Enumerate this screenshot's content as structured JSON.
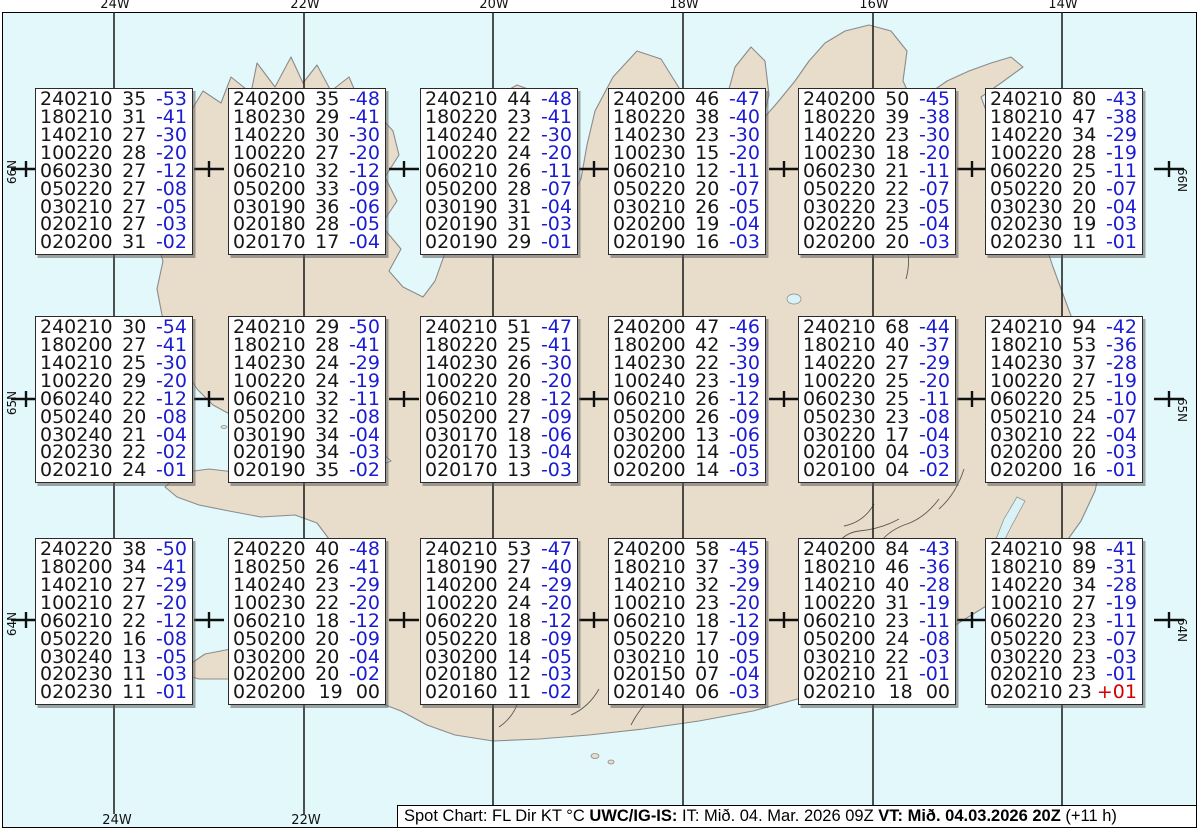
{
  "colors": {
    "ocean": "#e3f8fb",
    "land": "#e8dccb",
    "coast": "#8b8b8b",
    "rivers": "#5a5a52",
    "lake": "#d9f2f6",
    "grid": "#181818",
    "marker": "#101010",
    "temp_blue": "#1b1bd1",
    "temp_red": "#d40000",
    "text_black": "#161616"
  },
  "geo": {
    "top_labels": [
      {
        "label": "24W",
        "x": 115
      },
      {
        "label": "22W",
        "x": 305
      },
      {
        "label": "20W",
        "x": 494
      },
      {
        "label": "18W",
        "x": 684
      },
      {
        "label": "16W",
        "x": 874
      },
      {
        "label": "14W",
        "x": 1063
      }
    ],
    "bottom_labels": [
      {
        "label": "24W",
        "x": 117
      },
      {
        "label": "22W",
        "x": 306
      }
    ],
    "left_labels": [
      {
        "label": "66N",
        "y": 172
      },
      {
        "label": "65N",
        "y": 403
      },
      {
        "label": "64N",
        "y": 624
      }
    ],
    "right_labels": [
      {
        "label": "66N",
        "y": 180
      },
      {
        "label": "65N",
        "y": 410
      },
      {
        "label": "64N",
        "y": 630
      }
    ],
    "gridline_x": [
      115,
      305,
      494,
      684,
      874,
      1063
    ],
    "marker_rows_y": [
      170,
      400,
      621
    ],
    "marker_cols_x": [
      27,
      210,
      405,
      595,
      785,
      973,
      1170
    ]
  },
  "boxes": {
    "cols_x": [
      35,
      228,
      420,
      608,
      798,
      985
    ],
    "rows_y": [
      88,
      316,
      538
    ],
    "items": [
      {
        "r": 0,
        "c": 0,
        "lines": [
          [
            "240210",
            "35",
            "-53"
          ],
          [
            "180210",
            "31",
            "-41"
          ],
          [
            "140210",
            "27",
            "-30"
          ],
          [
            "100220",
            "28",
            "-20"
          ],
          [
            "060230",
            "27",
            "-12"
          ],
          [
            "050220",
            "27",
            "-08"
          ],
          [
            "030210",
            "27",
            "-05"
          ],
          [
            "020210",
            "27",
            "-03"
          ],
          [
            "020200",
            "31",
            "-02"
          ]
        ]
      },
      {
        "r": 0,
        "c": 1,
        "lines": [
          [
            "240200",
            "35",
            "-48"
          ],
          [
            "180230",
            "29",
            "-41"
          ],
          [
            "140220",
            "30",
            "-30"
          ],
          [
            "100220",
            "27",
            "-20"
          ],
          [
            "060210",
            "32",
            "-12"
          ],
          [
            "050200",
            "33",
            "-09"
          ],
          [
            "030190",
            "36",
            "-06"
          ],
          [
            "020180",
            "28",
            "-05"
          ],
          [
            "020170",
            "17",
            "-04"
          ]
        ]
      },
      {
        "r": 0,
        "c": 2,
        "lines": [
          [
            "240210",
            "44",
            "-48"
          ],
          [
            "180220",
            "23",
            "-41"
          ],
          [
            "140240",
            "22",
            "-30"
          ],
          [
            "100220",
            "24",
            "-20"
          ],
          [
            "060210",
            "26",
            "-11"
          ],
          [
            "050200",
            "28",
            "-07"
          ],
          [
            "030190",
            "31",
            "-04"
          ],
          [
            "020190",
            "31",
            "-03"
          ],
          [
            "020190",
            "29",
            "-01"
          ]
        ]
      },
      {
        "r": 0,
        "c": 3,
        "lines": [
          [
            "240200",
            "46",
            "-47"
          ],
          [
            "180220",
            "38",
            "-40"
          ],
          [
            "140230",
            "23",
            "-30"
          ],
          [
            "100230",
            "15",
            "-20"
          ],
          [
            "060210",
            "12",
            "-11"
          ],
          [
            "050220",
            "20",
            "-07"
          ],
          [
            "030210",
            "26",
            "-05"
          ],
          [
            "020200",
            "19",
            "-04"
          ],
          [
            "020190",
            "16",
            "-03"
          ]
        ]
      },
      {
        "r": 0,
        "c": 4,
        "lines": [
          [
            "240200",
            "50",
            "-45"
          ],
          [
            "180220",
            "39",
            "-38"
          ],
          [
            "140220",
            "23",
            "-30"
          ],
          [
            "100230",
            "18",
            "-20"
          ],
          [
            "060230",
            "21",
            "-11"
          ],
          [
            "050220",
            "22",
            "-07"
          ],
          [
            "030220",
            "23",
            "-05"
          ],
          [
            "020220",
            "25",
            "-04"
          ],
          [
            "020200",
            "20",
            "-03"
          ]
        ]
      },
      {
        "r": 0,
        "c": 5,
        "lines": [
          [
            "240210",
            "80",
            "-43"
          ],
          [
            "180210",
            "47",
            "-38"
          ],
          [
            "140220",
            "34",
            "-29"
          ],
          [
            "100220",
            "28",
            "-19"
          ],
          [
            "060220",
            "25",
            "-11"
          ],
          [
            "050220",
            "20",
            "-07"
          ],
          [
            "030230",
            "20",
            "-04"
          ],
          [
            "020230",
            "19",
            "-03"
          ],
          [
            "020230",
            "11",
            "-01"
          ]
        ]
      },
      {
        "r": 1,
        "c": 0,
        "lines": [
          [
            "240210",
            "30",
            "-54"
          ],
          [
            "180200",
            "27",
            "-41"
          ],
          [
            "140210",
            "25",
            "-30"
          ],
          [
            "100220",
            "29",
            "-20"
          ],
          [
            "060240",
            "22",
            "-12"
          ],
          [
            "050240",
            "20",
            "-08"
          ],
          [
            "030240",
            "21",
            "-04"
          ],
          [
            "020230",
            "22",
            "-02"
          ],
          [
            "020210",
            "24",
            "-01"
          ]
        ]
      },
      {
        "r": 1,
        "c": 1,
        "lines": [
          [
            "240210",
            "29",
            "-50"
          ],
          [
            "180210",
            "28",
            "-41"
          ],
          [
            "140230",
            "24",
            "-29"
          ],
          [
            "100220",
            "24",
            "-19"
          ],
          [
            "060210",
            "32",
            "-11"
          ],
          [
            "050200",
            "32",
            "-08"
          ],
          [
            "030190",
            "34",
            "-04"
          ],
          [
            "020190",
            "34",
            "-03"
          ],
          [
            "020190",
            "35",
            "-02"
          ]
        ]
      },
      {
        "r": 1,
        "c": 2,
        "lines": [
          [
            "240210",
            "51",
            "-47"
          ],
          [
            "180220",
            "25",
            "-41"
          ],
          [
            "140230",
            "26",
            "-30"
          ],
          [
            "100220",
            "20",
            "-20"
          ],
          [
            "060210",
            "28",
            "-12"
          ],
          [
            "050200",
            "27",
            "-09"
          ],
          [
            "030170",
            "18",
            "-06"
          ],
          [
            "020170",
            "13",
            "-04"
          ],
          [
            "020170",
            "13",
            "-03"
          ]
        ]
      },
      {
        "r": 1,
        "c": 3,
        "lines": [
          [
            "240200",
            "47",
            "-46"
          ],
          [
            "180200",
            "42",
            "-39"
          ],
          [
            "140230",
            "22",
            "-30"
          ],
          [
            "100240",
            "23",
            "-19"
          ],
          [
            "060210",
            "26",
            "-12"
          ],
          [
            "050200",
            "26",
            "-09"
          ],
          [
            "030200",
            "13",
            "-06"
          ],
          [
            "020200",
            "14",
            "-05"
          ],
          [
            "020200",
            "14",
            "-03"
          ]
        ]
      },
      {
        "r": 1,
        "c": 4,
        "lines": [
          [
            "240210",
            "68",
            "-44"
          ],
          [
            "180210",
            "40",
            "-37"
          ],
          [
            "140220",
            "27",
            "-29"
          ],
          [
            "100220",
            "25",
            "-20"
          ],
          [
            "060230",
            "25",
            "-11"
          ],
          [
            "050230",
            "23",
            "-08"
          ],
          [
            "030220",
            "17",
            "-04"
          ],
          [
            "020100",
            "04",
            "-03"
          ],
          [
            "020100",
            "04",
            "-02"
          ]
        ]
      },
      {
        "r": 1,
        "c": 5,
        "lines": [
          [
            "240210",
            "94",
            "-42"
          ],
          [
            "180210",
            "53",
            "-36"
          ],
          [
            "140230",
            "37",
            "-28"
          ],
          [
            "100220",
            "27",
            "-19"
          ],
          [
            "060220",
            "25",
            "-10"
          ],
          [
            "050210",
            "24",
            "-07"
          ],
          [
            "030210",
            "22",
            "-04"
          ],
          [
            "020200",
            "20",
            "-03"
          ],
          [
            "020200",
            "16",
            "-01"
          ]
        ]
      },
      {
        "r": 2,
        "c": 0,
        "lines": [
          [
            "240220",
            "38",
            "-50"
          ],
          [
            "180200",
            "34",
            "-41"
          ],
          [
            "140210",
            "27",
            "-29"
          ],
          [
            "100210",
            "27",
            "-20"
          ],
          [
            "060210",
            "22",
            "-12"
          ],
          [
            "050220",
            "16",
            "-08"
          ],
          [
            "030240",
            "13",
            "-05"
          ],
          [
            "020230",
            "11",
            "-03"
          ],
          [
            "020230",
            "11",
            "-01"
          ]
        ]
      },
      {
        "r": 2,
        "c": 1,
        "lines": [
          [
            "240220",
            "40",
            "-48"
          ],
          [
            "180250",
            "26",
            "-41"
          ],
          [
            "140240",
            "23",
            "-29"
          ],
          [
            "100230",
            "22",
            "-20"
          ],
          [
            "060210",
            "18",
            "-12"
          ],
          [
            "050200",
            "20",
            "-09"
          ],
          [
            "030200",
            "20",
            "-04"
          ],
          [
            "020200",
            "20",
            "-02"
          ],
          [
            "020200",
            "19",
            "00",
            "black"
          ]
        ]
      },
      {
        "r": 2,
        "c": 2,
        "lines": [
          [
            "240210",
            "53",
            "-47"
          ],
          [
            "180190",
            "27",
            "-40"
          ],
          [
            "140200",
            "24",
            "-29"
          ],
          [
            "100220",
            "24",
            "-20"
          ],
          [
            "060220",
            "18",
            "-12"
          ],
          [
            "050220",
            "18",
            "-09"
          ],
          [
            "030200",
            "14",
            "-05"
          ],
          [
            "020180",
            "12",
            "-03"
          ],
          [
            "020160",
            "11",
            "-02"
          ]
        ]
      },
      {
        "r": 2,
        "c": 3,
        "lines": [
          [
            "240200",
            "58",
            "-45"
          ],
          [
            "180210",
            "37",
            "-39"
          ],
          [
            "140210",
            "32",
            "-29"
          ],
          [
            "100210",
            "23",
            "-20"
          ],
          [
            "060210",
            "18",
            "-12"
          ],
          [
            "050220",
            "17",
            "-09"
          ],
          [
            "030210",
            "10",
            "-05"
          ],
          [
            "020150",
            "07",
            "-04"
          ],
          [
            "020140",
            "06",
            "-03"
          ]
        ]
      },
      {
        "r": 2,
        "c": 4,
        "lines": [
          [
            "240200",
            "84",
            "-43"
          ],
          [
            "180210",
            "46",
            "-36"
          ],
          [
            "140210",
            "40",
            "-28"
          ],
          [
            "100220",
            "31",
            "-19"
          ],
          [
            "060210",
            "23",
            "-11"
          ],
          [
            "050200",
            "24",
            "-08"
          ],
          [
            "030210",
            "22",
            "-03"
          ],
          [
            "020210",
            "21",
            "-01"
          ],
          [
            "020210",
            "18",
            "00",
            "black"
          ]
        ]
      },
      {
        "r": 2,
        "c": 5,
        "lines": [
          [
            "240210",
            "98",
            "-41"
          ],
          [
            "180210",
            "89",
            "-31"
          ],
          [
            "140220",
            "34",
            "-28"
          ],
          [
            "100210",
            "27",
            "-19"
          ],
          [
            "060220",
            "23",
            "-11"
          ],
          [
            "050220",
            "23",
            "-07"
          ],
          [
            "030220",
            "23",
            "-03"
          ],
          [
            "020210",
            "23",
            "-01"
          ],
          [
            "020210",
            "23",
            "+01",
            "red"
          ]
        ]
      }
    ]
  },
  "legend": {
    "segments": [
      {
        "t": "Spot Chart: FL Dir KT °C ",
        "b": false
      },
      {
        "t": "UWC/IG-IS:",
        "b": true
      },
      {
        "t": " IT: Mið. 04. Mar. 2026 09Z ",
        "b": false
      },
      {
        "t": "VT: Mið. 04.03.2026 20Z",
        "b": true
      },
      {
        "t": " (+11 h)",
        "b": false
      }
    ]
  }
}
